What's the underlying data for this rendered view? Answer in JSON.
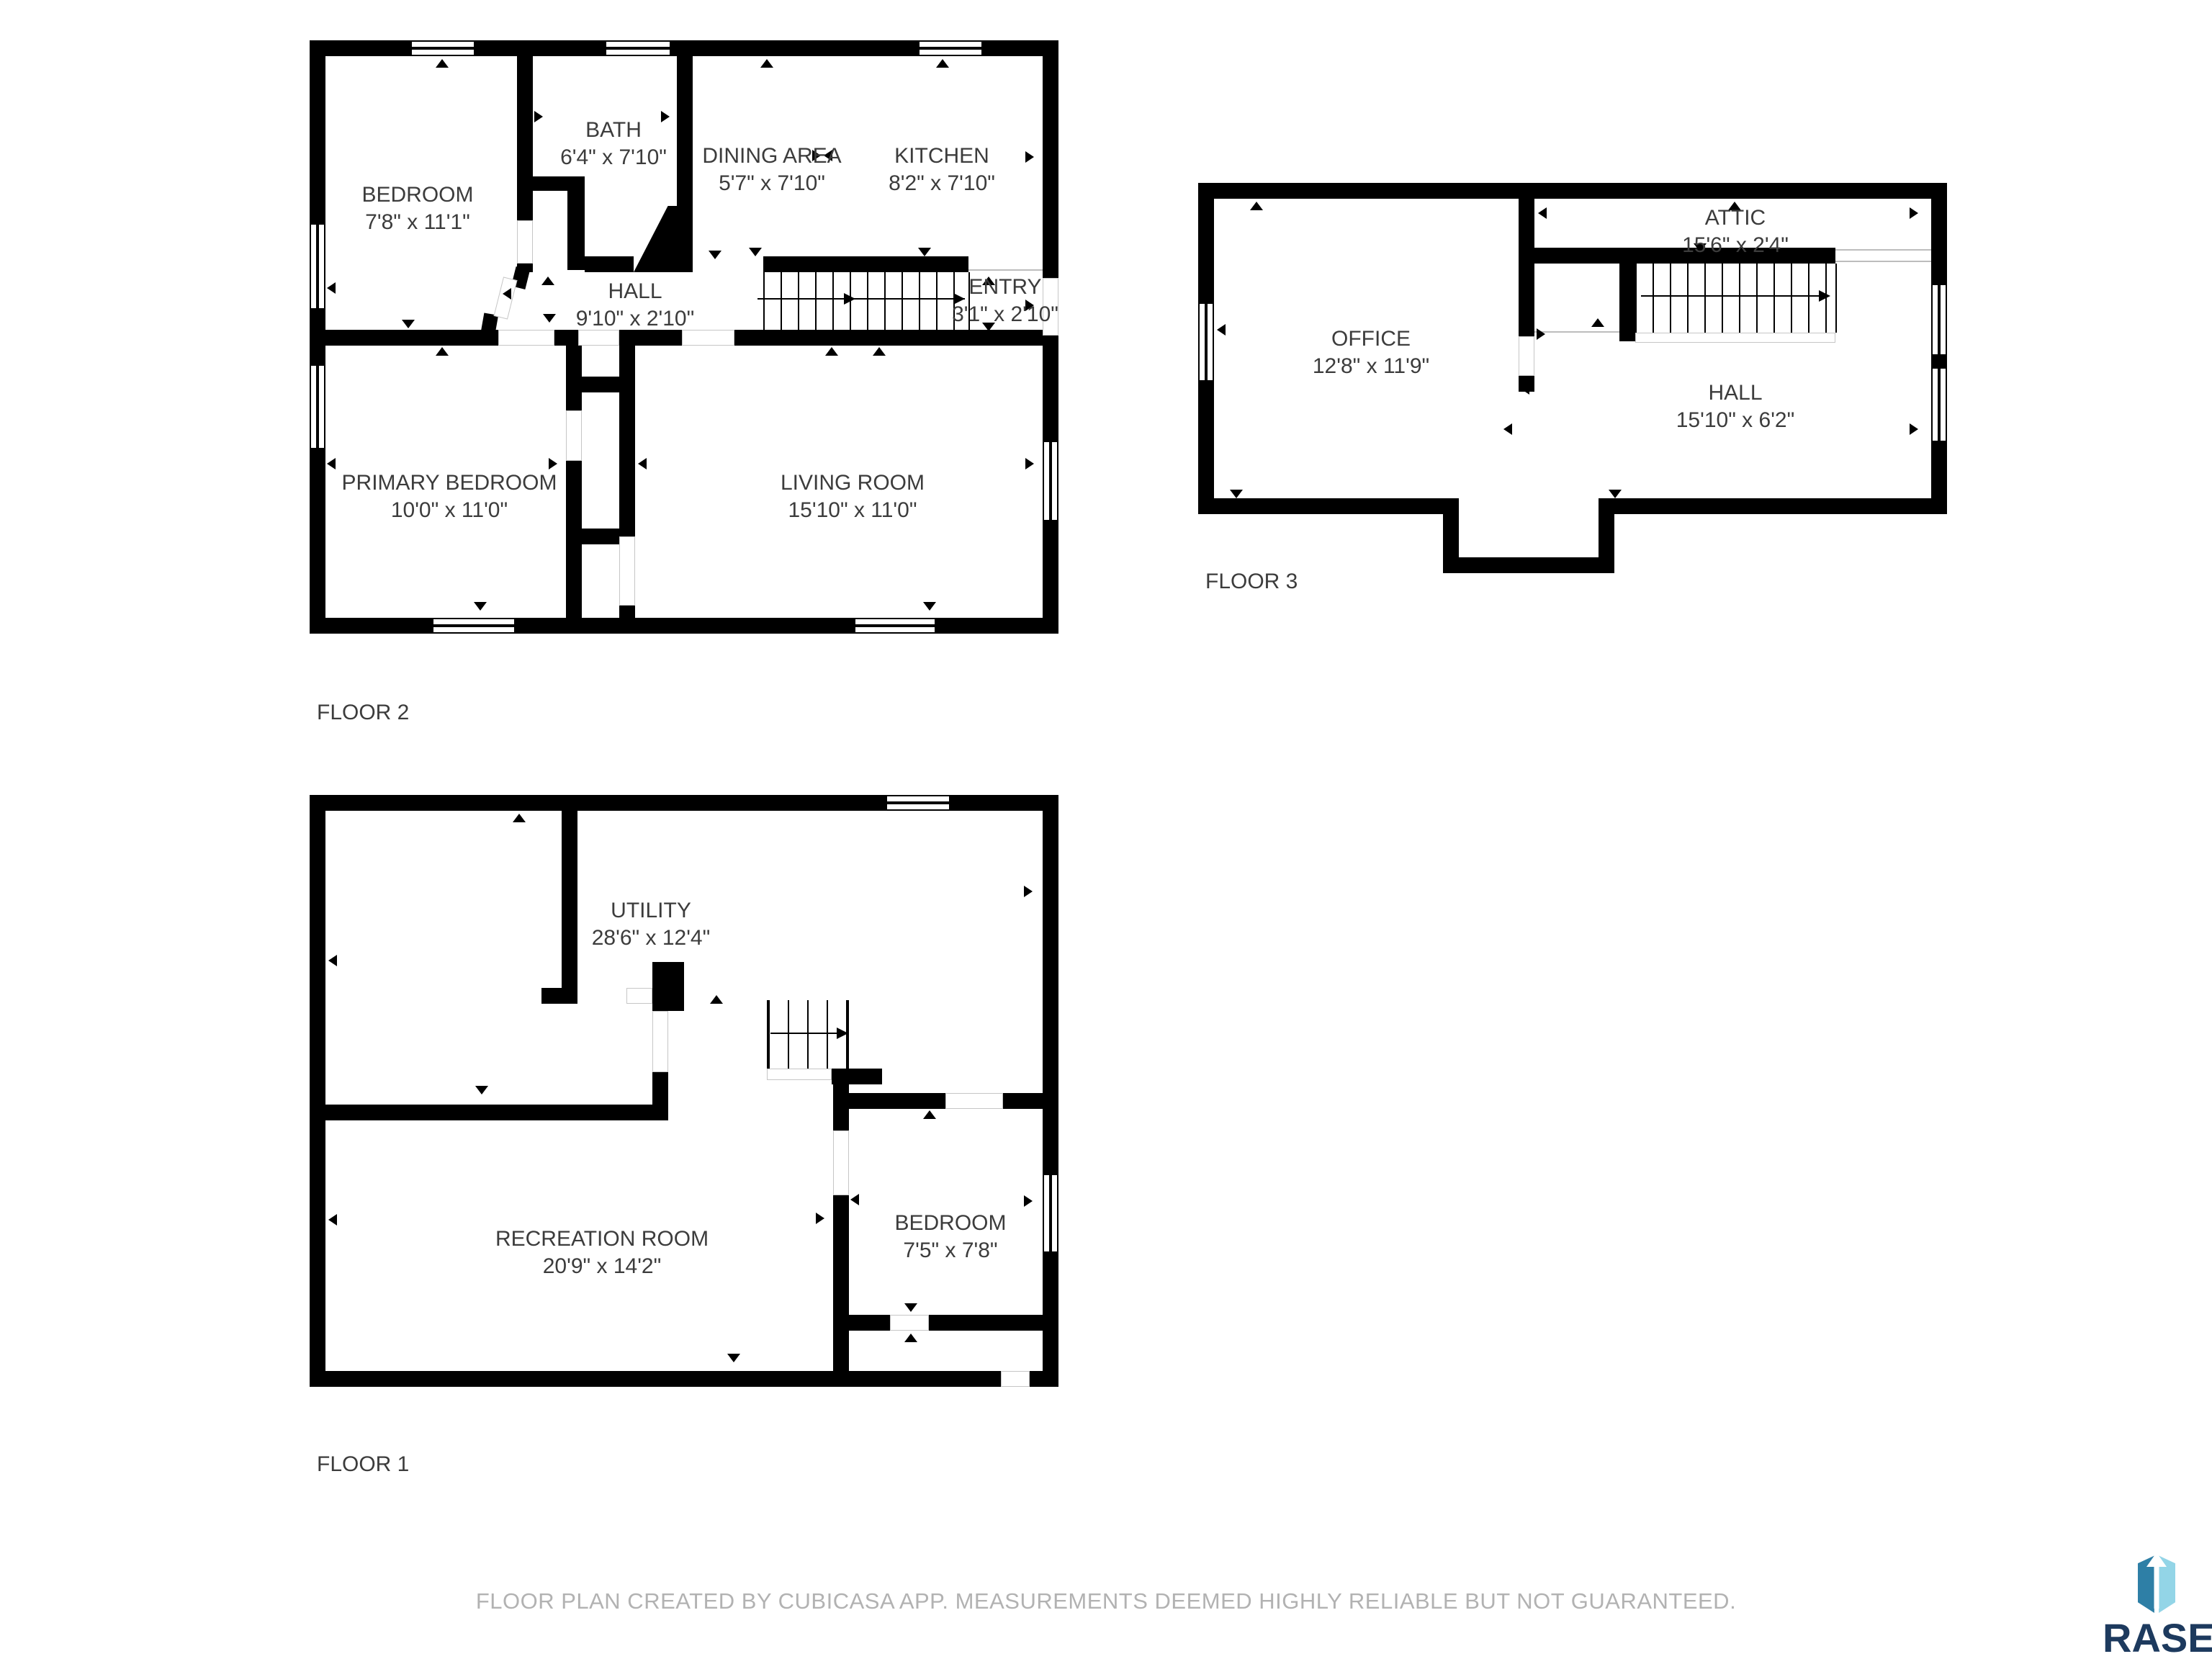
{
  "floors": {
    "floor2": {
      "caption": "FLOOR 2",
      "rooms": {
        "bedroom": {
          "name": "BEDROOM",
          "dims": "7'8\" x 11'1\""
        },
        "bath": {
          "name": "BATH",
          "dims": "6'4\" x 7'10\""
        },
        "dining": {
          "name": "DINING AREA",
          "dims": "5'7\" x 7'10\""
        },
        "kitchen": {
          "name": "KITCHEN",
          "dims": "8'2\" x 7'10\""
        },
        "hall": {
          "name": "HALL",
          "dims": "9'10\" x 2'10\""
        },
        "entry": {
          "name": "ENTRY",
          "dims": "3'1\" x 2'10\""
        },
        "primary": {
          "name": "PRIMARY BEDROOM",
          "dims": "10'0\" x 11'0\""
        },
        "living": {
          "name": "LIVING ROOM",
          "dims": "15'10\" x 11'0\""
        }
      }
    },
    "floor3": {
      "caption": "FLOOR 3",
      "rooms": {
        "attic": {
          "name": "ATTIC",
          "dims": "15'6\" x 2'4\""
        },
        "office": {
          "name": "OFFICE",
          "dims": "12'8\" x 11'9\""
        },
        "hall": {
          "name": "HALL",
          "dims": "15'10\" x 6'2\""
        }
      }
    },
    "floor1": {
      "caption": "FLOOR 1",
      "rooms": {
        "utility": {
          "name": "UTILITY",
          "dims": "28'6\" x 12'4\""
        },
        "recreation": {
          "name": "RECREATION ROOM",
          "dims": "20'9\" x 14'2\""
        },
        "bedroom": {
          "name": "BEDROOM",
          "dims": "7'5\" x 7'8\""
        }
      }
    }
  },
  "footer": {
    "disclaimer": "FLOOR PLAN CREATED BY CUBICASA APP. MEASUREMENTS DEEMED HIGHLY RELIABLE BUT NOT GUARANTEED."
  },
  "logo": {
    "text": "RASE"
  },
  "colors": {
    "wall": "#000000",
    "room_text": "#3c3c3c",
    "footer_text": "#b2b2b2",
    "logo_navy": "#1d3a5e",
    "logo_teal": "#2e7fa6",
    "logo_light_blue": "#93d5e7"
  }
}
